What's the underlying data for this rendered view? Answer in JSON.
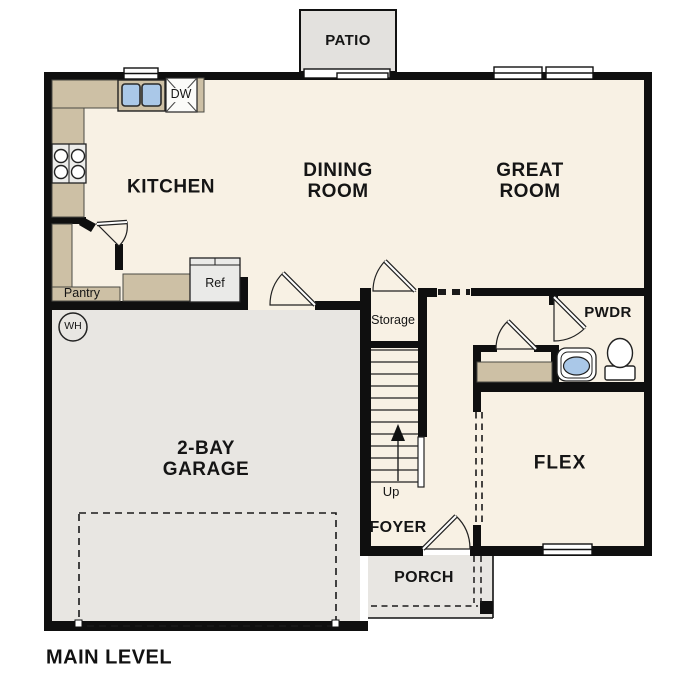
{
  "title": "MAIN LEVEL",
  "rooms": {
    "patio": "PATIO",
    "kitchen": "KITCHEN",
    "dining": {
      "line1": "DINING",
      "line2": "ROOM"
    },
    "great": {
      "line1": "GREAT",
      "line2": "ROOM"
    },
    "garage": {
      "line1": "2-BAY",
      "line2": "GARAGE"
    },
    "flex": "FLEX",
    "foyer": "FOYER",
    "porch": "PORCH",
    "pwdr": "PWDR",
    "storage": "Storage",
    "pantry": "Pantry"
  },
  "fixtures": {
    "ref": "Ref",
    "dw": "DW",
    "wh": "WH",
    "up": "Up"
  },
  "colors": {
    "floor": "#F8F1E4",
    "garage_floor": "#E8E6E2",
    "patio_floor": "#E3E1DE",
    "counter_tan": "#CDC0A5",
    "wall_black": "#0F0F0F",
    "sink_blue": "#AAC8E8"
  }
}
